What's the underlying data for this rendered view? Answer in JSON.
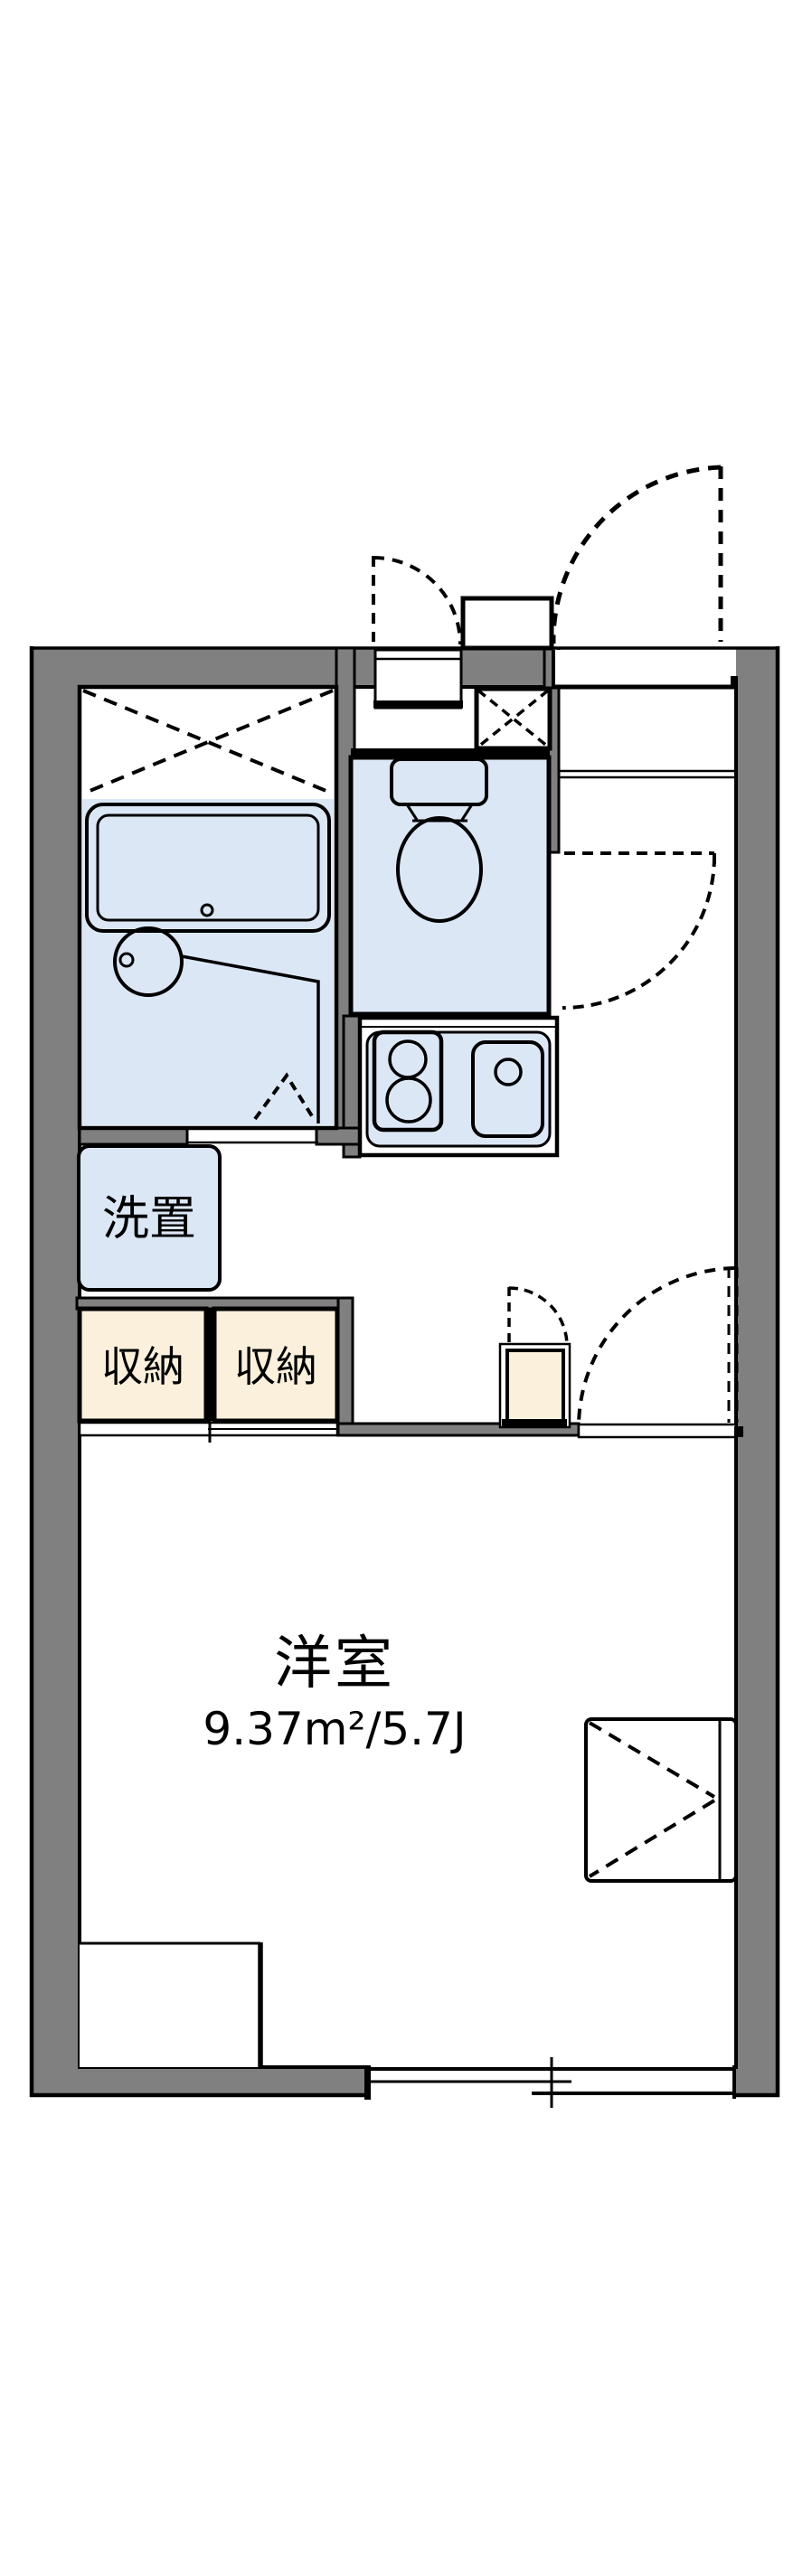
{
  "plan": {
    "rooms": {
      "main": {
        "label": "洋室",
        "area": "9.37m²/5.7J"
      },
      "laundry": {
        "label": "洗置"
      },
      "storage_left": {
        "label": "収納"
      },
      "storage_right": {
        "label": "収納"
      }
    },
    "colors": {
      "wall": "#808080",
      "fixture_fill": "#dce7f6",
      "storage_fill": "#faf0dc",
      "line": "#000000",
      "background": "#ffffff"
    }
  }
}
